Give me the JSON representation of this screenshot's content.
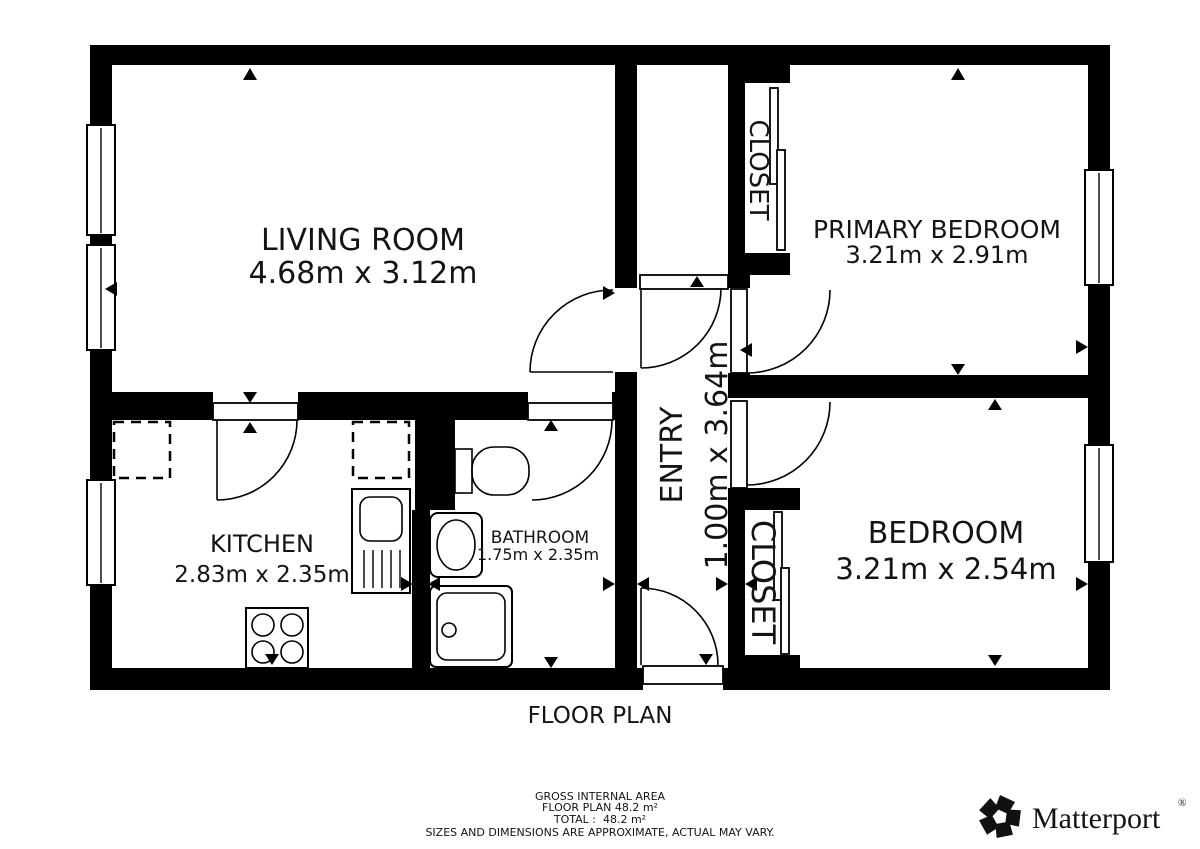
{
  "plan": {
    "title": "FLOOR PLAN",
    "rooms": {
      "living_room": {
        "name": "LIVING ROOM",
        "dims": "4.68m x 3.12m"
      },
      "primary_bedroom": {
        "name": "PRIMARY BEDROOM",
        "dims": "3.21m x 2.91m"
      },
      "bedroom": {
        "name": "BEDROOM",
        "dims": "3.21m x 2.54m"
      },
      "kitchen": {
        "name": "KITCHEN",
        "dims": "2.83m x 2.35m"
      },
      "bathroom": {
        "name": "BATHROOM",
        "dims": "1.75m x 2.35m"
      },
      "entry": {
        "name": "ENTRY",
        "dims": "1.00m x 3.64m"
      },
      "closet_primary": {
        "name": "CLOSET"
      },
      "closet_bedroom": {
        "name": "CLOSET"
      }
    }
  },
  "footer": {
    "gross_internal_area": "GROSS INTERNAL AREA",
    "floor_plan_area": "FLOOR PLAN 48.2 m²",
    "total": "TOTAL :  48.2 m²",
    "disclaimer": "SIZES AND DIMENSIONS ARE APPROXIMATE, ACTUAL MAY VARY."
  },
  "branding": {
    "logo_text": "Matterport",
    "registered_mark": "®"
  },
  "colors": {
    "wall": "#000000",
    "background": "#ffffff",
    "text": "#141414",
    "disclaimer_gray": "#9a9a9a"
  }
}
